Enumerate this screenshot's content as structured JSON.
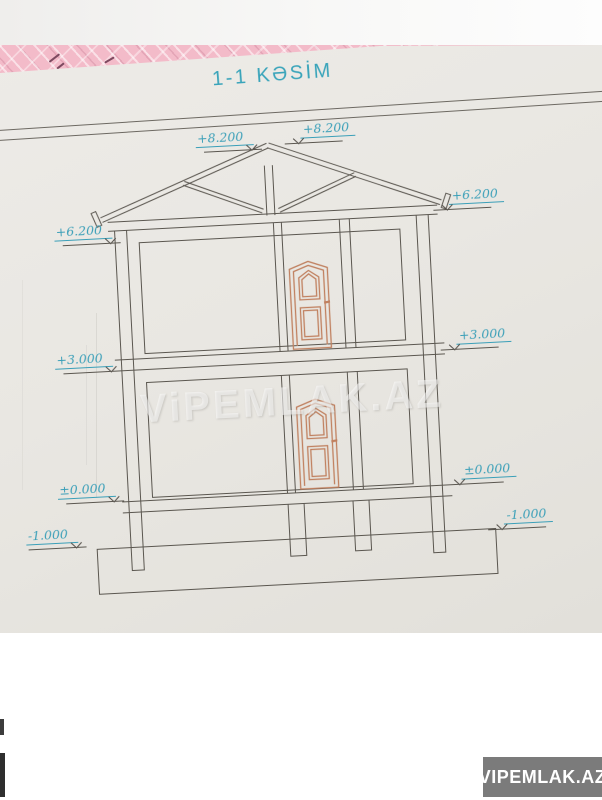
{
  "page": {
    "title": "1-1 KƏSİM",
    "watermark": "ViPEMLAK.AZ",
    "badge": "VIPEMLAK.AZ"
  },
  "drawing": {
    "type": "building-cross-section",
    "markers": [
      {
        "label": "+8.200",
        "position": "ridge-left"
      },
      {
        "label": "+8.200",
        "position": "ridge-right"
      },
      {
        "label": "+6.200",
        "position": "eaves-left"
      },
      {
        "label": "+6.200",
        "position": "eaves-right"
      },
      {
        "label": "+3.000",
        "position": "second-floor-left"
      },
      {
        "label": "+3.000",
        "position": "second-floor-right"
      },
      {
        "label": "±0.000",
        "position": "ground-floor-left"
      },
      {
        "label": "±0.000",
        "position": "ground-floor-right"
      },
      {
        "label": "-1.000",
        "position": "foundation-left"
      },
      {
        "label": "-1.000",
        "position": "foundation-right"
      }
    ]
  },
  "colors": {
    "title_teal": "#39a4ba",
    "marker_teal": "#3a9fb8",
    "drawing_line": "#5a564f",
    "door_orange": "#c0805f",
    "sheet_paper": "#e9e7e2",
    "pink_sheet": "#f3bbc9",
    "badge_background": "#7b7b7b",
    "badge_text": "#ffffff"
  }
}
